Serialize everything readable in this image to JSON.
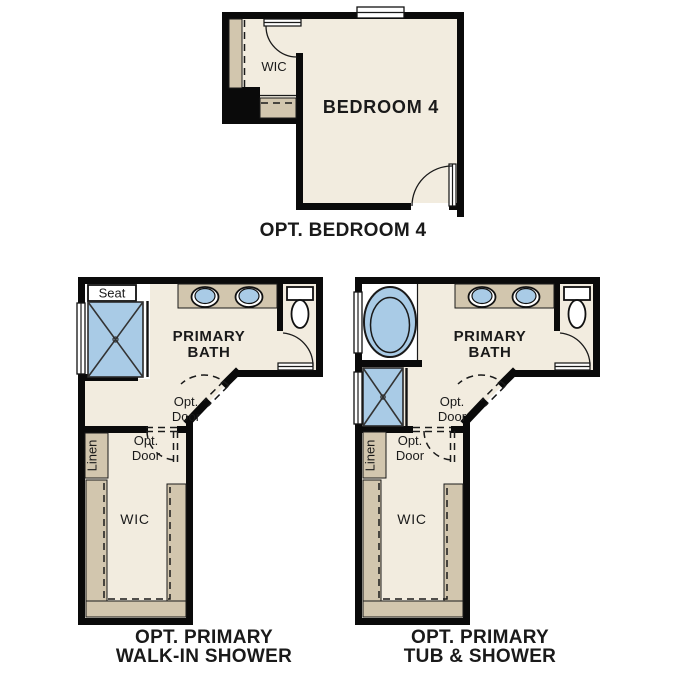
{
  "colors": {
    "wall": "#0a0a0a",
    "floor": "#f2ecdf",
    "cabinet_tan": "#d2c6ae",
    "fixture_blue": "#a9cbe6",
    "fixture_white": "#ffffff",
    "label_text": "#1a1a1a",
    "background": "#ffffff"
  },
  "plans": {
    "bedroom4": {
      "caption": "OPT. BEDROOM 4",
      "labels": {
        "wic": "WIC",
        "bedroom": "BEDROOM 4"
      }
    },
    "walkin_shower": {
      "caption_line1": "OPT. PRIMARY",
      "caption_line2": "WALK-IN SHOWER",
      "labels": {
        "seat": "Seat",
        "bath_line1": "PRIMARY",
        "bath_line2": "BATH",
        "opt": "Opt.",
        "door": "Door",
        "linen": "Linen",
        "wic": "WIC"
      }
    },
    "tub_shower": {
      "caption_line1": "OPT. PRIMARY",
      "caption_line2": "TUB & SHOWER",
      "labels": {
        "bath_line1": "PRIMARY",
        "bath_line2": "BATH",
        "opt": "Opt.",
        "door": "Door",
        "linen": "Linen",
        "wic": "WIC"
      }
    }
  }
}
